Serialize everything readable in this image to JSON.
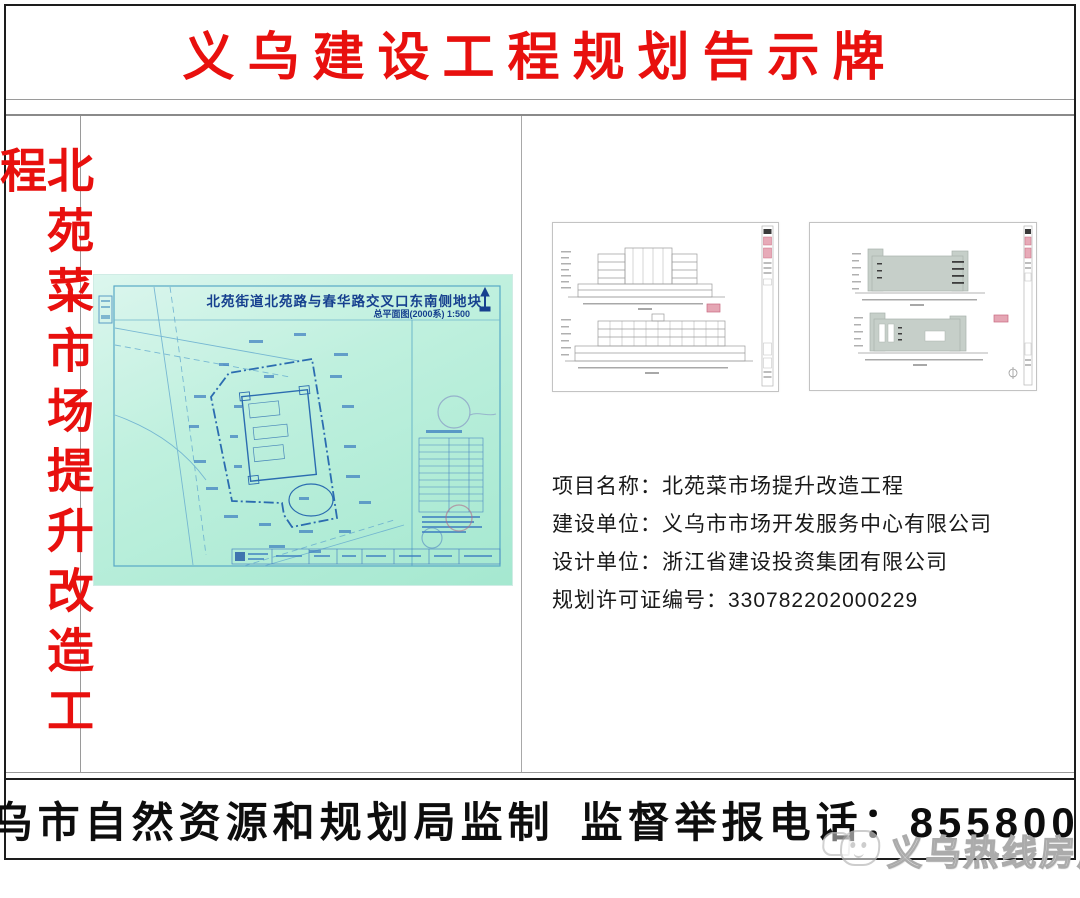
{
  "header": {
    "title": "义乌建设工程规划告示牌"
  },
  "sidebar": {
    "project_name_vertical": "北苑菜市场提升改造工程"
  },
  "site_plan": {
    "title": "北苑街道北苑路与春华路交叉口东南侧地块",
    "subtitle": "总平面图(2000系) 1:500"
  },
  "project_info": {
    "lines": [
      "项目名称：北苑菜市场提升改造工程",
      "建设单位：义乌市市场开发服务中心有限公司",
      "设计单位：浙江省建设投资集团有限公司",
      "规划许可证编号：330782202000229"
    ]
  },
  "footer": {
    "supervisor": "义乌市自然资源和规划局监制",
    "hotline": "监督举报电话：85580031"
  },
  "watermark": {
    "text": "义乌热线房产"
  },
  "colors": {
    "accent_red": "#e8100e",
    "plan_background": "#a5e8d0",
    "plan_line_blue": "#2b6cb0",
    "stamp_pink": "#d4607a"
  }
}
